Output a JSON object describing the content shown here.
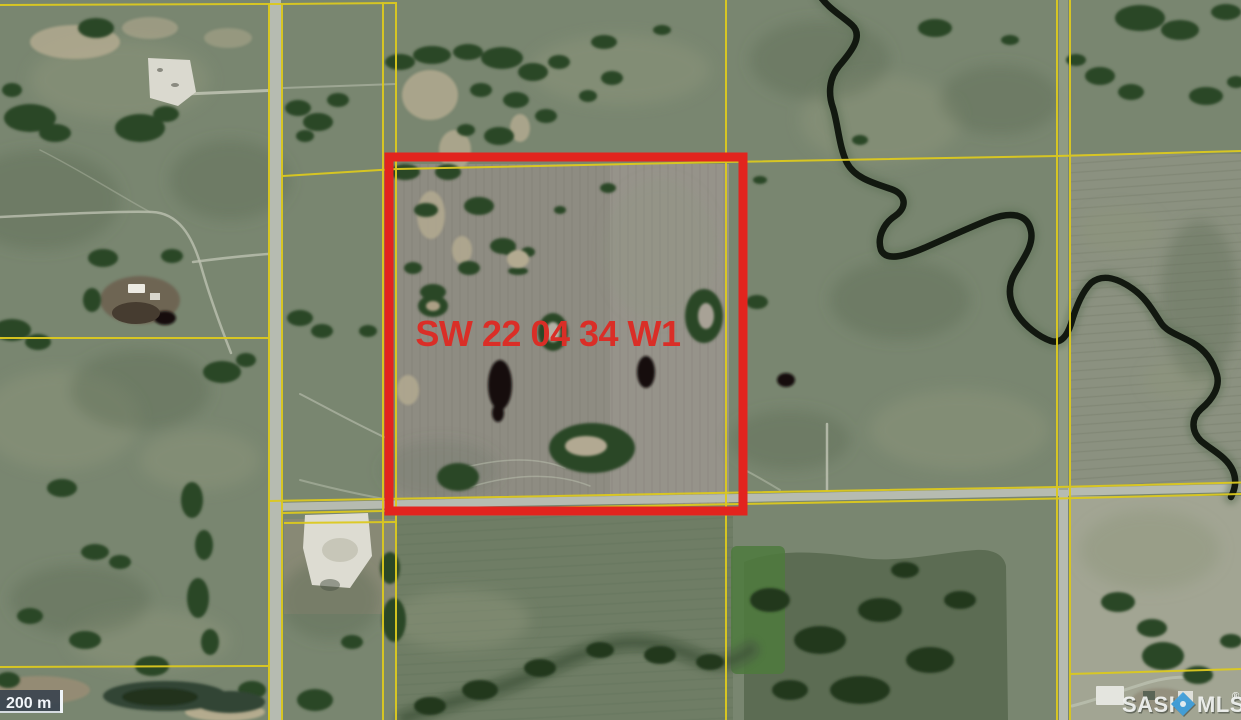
{
  "map": {
    "parcel_label": "SW 22 04 34 W1",
    "scale_bar": {
      "distance_label": "200 m"
    },
    "watermark": {
      "prefix": "SASK",
      "suffix": "MLS",
      "registered_mark": "®"
    },
    "colors": {
      "highlight_red": "#e2241e",
      "label_red": "#da2e27",
      "cadastral_yellow": "#dcc91f",
      "watermark_text": "#f3f5f3",
      "watermark_blue": "#41a2e0",
      "scalebar_bg": "#37414d",
      "scalebar_text": "#f2f6fa"
    }
  }
}
